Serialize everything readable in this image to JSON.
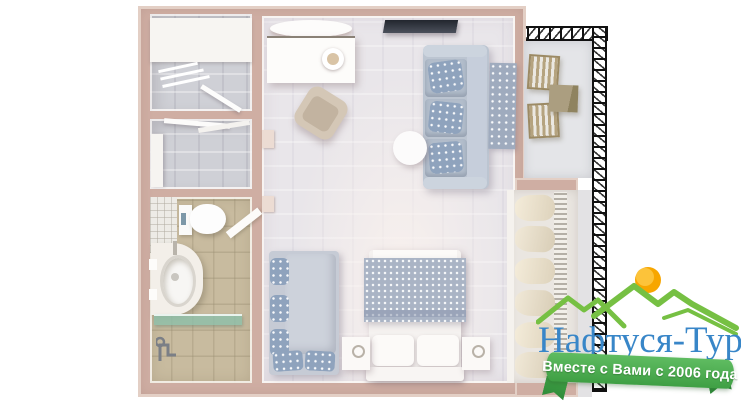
{
  "logo": {
    "title": "Нафтуся-Тур",
    "tagline": "Вместе с Вами с 2006 года",
    "colors": {
      "title_blue": "#3886c8",
      "ribbon_green": "#4aae4d",
      "ribbon_green_dark": "#2f8b3a",
      "mountain_green": "#76c043",
      "sun_orange": "#f7a600"
    }
  },
  "floorplan": {
    "description": "3D top-down render of a one-room apartment suite with balcony",
    "colors": {
      "walls": "#cfaea3",
      "main_floor": "#e9e6ea",
      "bathroom_floor": "#c8bb9f",
      "storage_floor": "#cfd0d6",
      "balcony_floor": "#e4e5e8",
      "sofa": "#bcc5d1",
      "floral_textile": "#8fa3bd",
      "armchair": "#d4c7b6",
      "wood_furniture": "#b3a284",
      "tv": "#3a3f4a",
      "glass_shelf": "#8cbfa9"
    },
    "rooms": [
      {
        "name": "storage-room-top"
      },
      {
        "name": "storage-room-middle"
      },
      {
        "name": "bathroom"
      },
      {
        "name": "living-bedroom"
      },
      {
        "name": "balcony"
      },
      {
        "name": "wardrobe-niche"
      }
    ]
  }
}
